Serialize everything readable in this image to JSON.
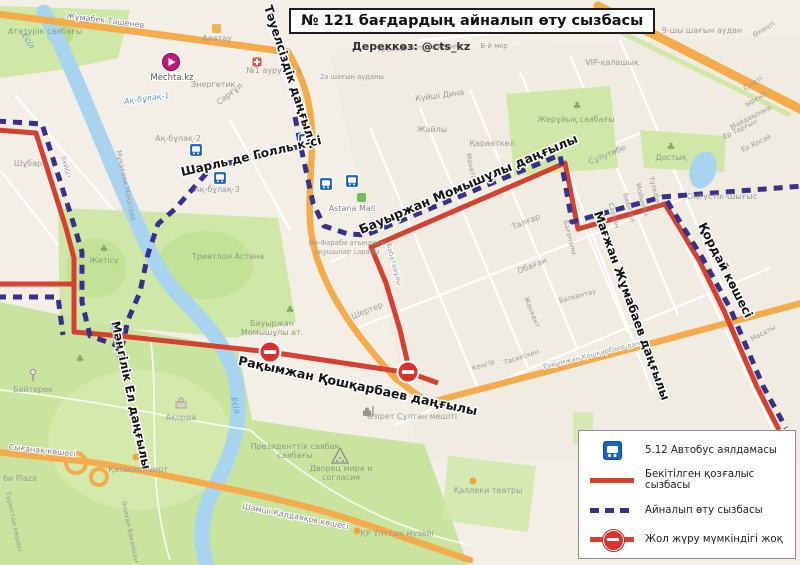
{
  "title": "№ 121 бағдардың айналып өту сызбасы",
  "source": "Дереккөз: @cts_kz",
  "legend": {
    "items": [
      {
        "symbol": "bus-stop",
        "label": "5.12 Автобус аялдамасы"
      },
      {
        "symbol": "red-solid-line",
        "label": "Бекітілген қозғалыс сызбасы"
      },
      {
        "symbol": "blue-dashed-line",
        "label": "Айналып өту сызбасы"
      },
      {
        "symbol": "no-entry",
        "label": "Жол жүру мүмкіндігі жоқ"
      }
    ]
  },
  "colors": {
    "fixed_route_red": "#d6402f",
    "detour_blue": "#35318c",
    "road_orange": "#f5ab4a",
    "water": "#a8d4f0",
    "park_green": "#cfe8a8",
    "bus_stop_blue": "#1863c6",
    "map_background": "#f3efe7"
  },
  "map": {
    "labels": {
      "tashenev": "Жұмабек Тәшенев",
      "ataturk_park": "Ататүрік саябағы",
      "esil1": "Есіл",
      "alatau": "Алатау",
      "mechta": "Mechta.kz",
      "energetik": "Энергетик",
      "hospital1": "№1 аурухана",
      "sargul": "Сәрғұл",
      "tauelsizdik": "Тәуелсіздік даңғылы",
      "charles_de_gaulle": "Шарль де Голль к-сі",
      "akbulak1": "Ақ-бұлақ-1",
      "akbulak2": "Ақ-бұлақ-2",
      "akbulak3": "Ақ-бұлақ-3",
      "alexey_petrov": "Алексей Петров көшесі",
      "district2a": "2а шағын ауданы",
      "kuishi_dina": "Күйші Дина",
      "zhaily": "Жайлы",
      "karaotkel": "Қараөткел",
      "manata": "Маната",
      "zheruiyk_park": "Жерұйық саябағы",
      "sulutobe": "Сұлутөбе",
      "dostyk": "Достық",
      "ontustik_shygys": "Оңтүстік-Шығыс",
      "district9": "9-шы шағын аудан",
      "vip": "VIP-қалашық",
      "olenti": "Өлеңті",
      "sileti": "Сілеті",
      "yrgyz": "Ырғыз",
      "maidakonyr": "Майдақоңыр",
      "er_targyn": "Ер Тарғын",
      "er_kosai": "Ер Қосай",
      "b_mkr": "Б-й мкр",
      "momyshuly_ave": "Бауыржан Момышұлы даңғылы",
      "zhumabaev_ave": "Мағжан Жұмабаев даңғылы",
      "korday_st": "Қордай көшесі",
      "koshkarbaev_ave": "Рақымжан Қошқарбаев даңғылы",
      "mangilik_el_ave": "Мәңгілік Ел даңғылы",
      "astana_mall": "Astana Mall",
      "al_farabi1": "Әл-Фараби атындағы",
      "al_farabi2": "оқушылар сарайы",
      "babataiuly": "Бабатайұлы",
      "sherter": "Шертер",
      "talgar": "Талғар",
      "obagan": "Обаған",
      "zhankent": "Жанкент",
      "taskesken": "Таскескен",
      "kengir": "Кеңгір",
      "balkantau": "Балқантау",
      "masaty": "Масаты",
      "triathlon": "Триатлон Астана",
      "momyshuly_park1": "Бауыржан",
      "momyshuly_park2": "Момышұлы ат.",
      "zhetisu": "Жетісу",
      "shubar": "Шұбар",
      "beibit": "Бейбіт",
      "makataev": "Мұқағали Мақатаев",
      "baiterek": "Байтерек",
      "akorda": "Ақорда",
      "esil2": "Есіл",
      "syganak": "Сығанақ көшесі",
      "kazakconcert": "Қазақконцерт",
      "bi_plaza": "би Plaza",
      "turkistan": "Түркістан көшесі",
      "bokeikhan": "Әлихан Бөкейхан",
      "kaldayakov": "Шәмші Қалдаяқов көшесі",
      "president_park1": "Президенттік саябақ",
      "president_park2": "саябағы",
      "palace1": "Дворец мира и",
      "palace2": "согласия",
      "museum": "ҚР Ұлттық музейі",
      "mosque": "Әзірет Сұлтан мешіті",
      "kalleki": "Қаллеки театры",
      "mangilik_el_small": "Мәңгілік Ел",
      "koshkarbaev_small": "Рақымжан Қошқарбаев дан",
      "tulkibas": "Түлкібас",
      "moiynty": "Мойынты",
      "bayantal": "Баянтал",
      "sarkan": "Сарқан",
      "baganaly": "Бағаналы"
    }
  }
}
